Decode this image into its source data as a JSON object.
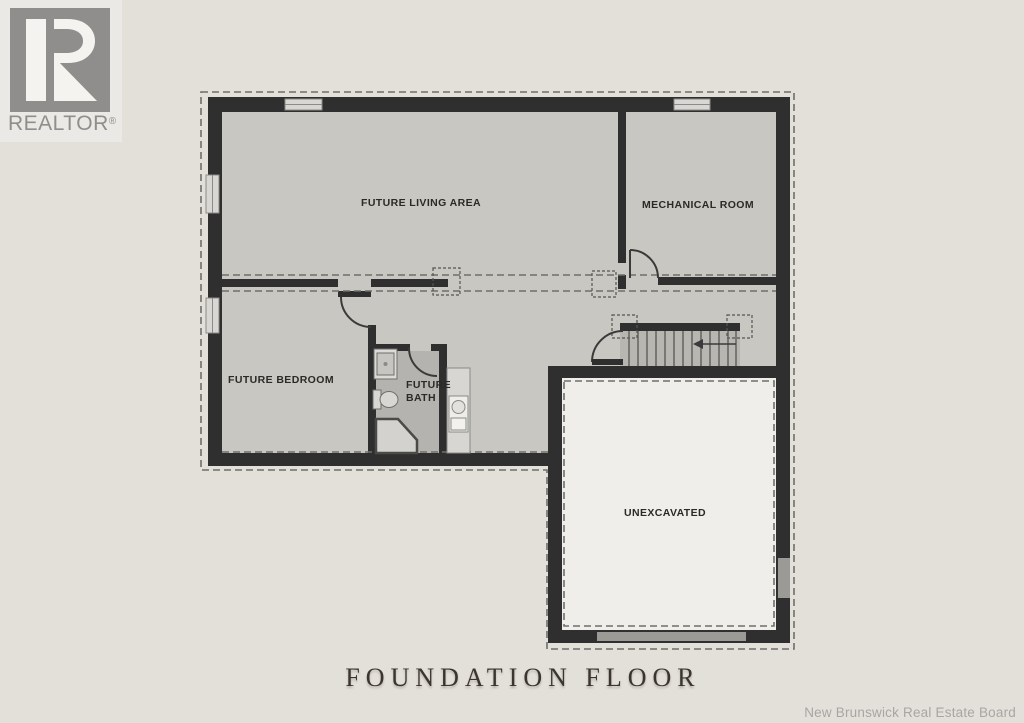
{
  "branding": {
    "realtor": "REALTOR",
    "registered": "®"
  },
  "plan": {
    "labels": {
      "living": "FUTURE LIVING AREA",
      "mechanical": "MECHANICAL ROOM",
      "bedroom": "FUTURE BEDROOM",
      "bath_line1": "FUTURE",
      "bath_line2": "BATH",
      "unexcavated": "UNEXCAVATED"
    },
    "title": "FOUNDATION FLOOR"
  },
  "footer": {
    "credit": "New Brunswick Real Estate Board"
  },
  "colors": {
    "background": "#e3e0da",
    "wall": "#2f2f2f",
    "floor": "#c8c7c2",
    "bath_floor": "#b4b3af",
    "unexcavated": "#efeeeb",
    "stairs": "#b7b6b1",
    "window": "#d8d7d3",
    "opening": "#9b9a96",
    "dashed_line": "#6e6e6a",
    "logo_gray": "#8f8e8c"
  }
}
